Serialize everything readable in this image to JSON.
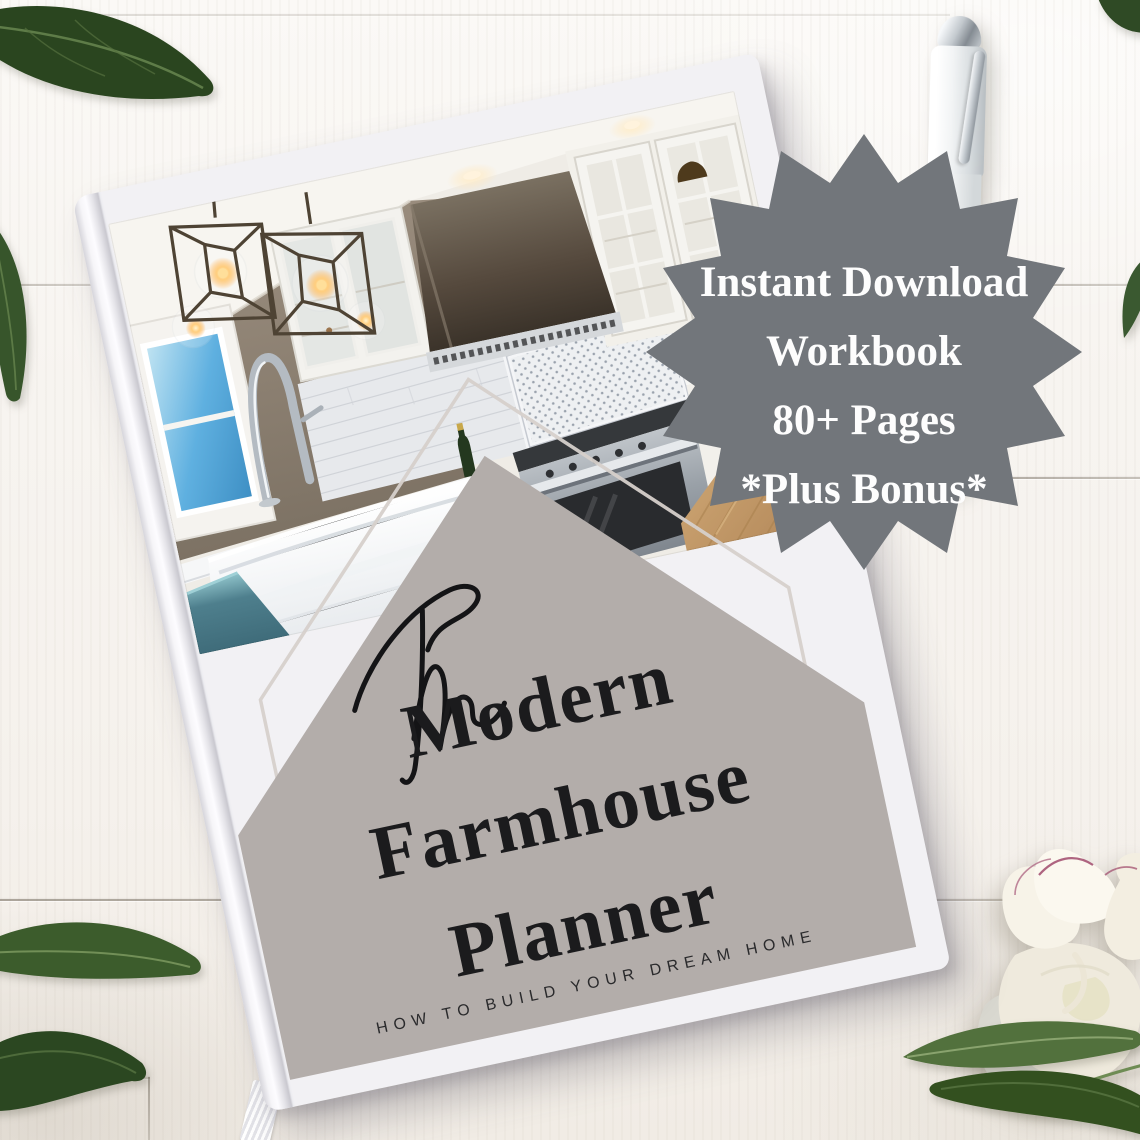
{
  "badge": {
    "shape": "starburst-16-point",
    "background_color": "#72767b",
    "text_color": "#fdfdfd",
    "lines": [
      "Instant Download",
      "Workbook",
      "80+ Pages",
      "*Plus Bonus*"
    ]
  },
  "book_cover": {
    "script_word": "The",
    "title_lines": [
      "Modern",
      "Farmhouse",
      "Planner"
    ],
    "subtitle": "HOW TO BUILD YOUR DREAM HOME",
    "house_shape_color": "#b3adaa",
    "title_ink_color": "#1b1b1d",
    "cover_color": "#f2f1f4",
    "photo_subject": "modern farmhouse kitchen"
  },
  "scene": {
    "surface": "white shiplap wood table",
    "decorations": [
      "green-leaves",
      "white-pen",
      "white-peony-flower",
      "ribbon-bookmark"
    ],
    "colors": {
      "wood_white": "#f7f4f0",
      "leaf_green_dark": "#2b4721",
      "leaf_green_mid": "#4f6b3c",
      "pen_white": "#eef0f1",
      "peony_cream": "#f6f2e7",
      "peony_accent": "#a04a6c",
      "kitchen_wall_taupe": "#8a7e6e",
      "kitchen_teal_cabinet": "#4e7f8d",
      "kitchen_floor_wood": "#c19a67"
    }
  }
}
